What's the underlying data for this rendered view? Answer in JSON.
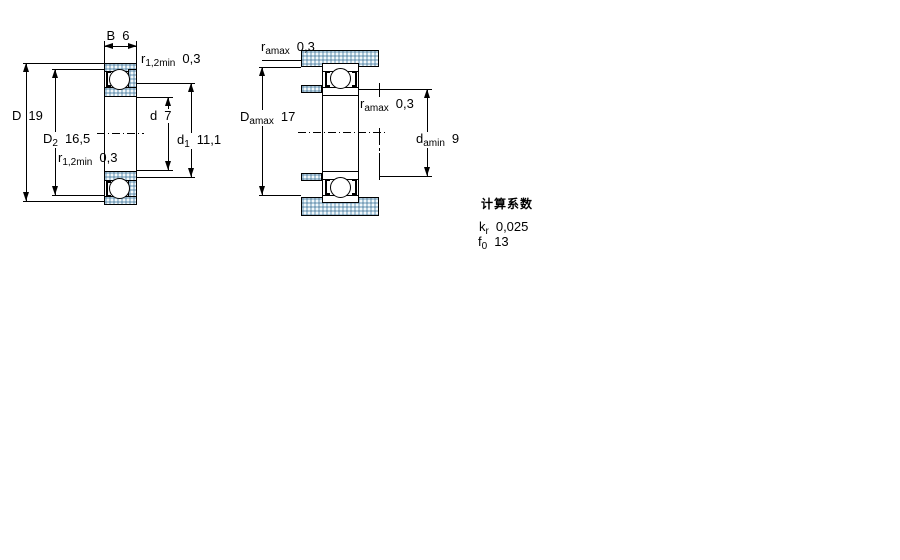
{
  "colors": {
    "background": "#ffffff",
    "line": "#000000",
    "hatch_fill": "#abc8da",
    "hatch_dot": "#7fa0b8"
  },
  "view1": {
    "name": "bearing cross-section, boundary dimensions",
    "dims": {
      "B": {
        "symbol": "B",
        "subscript": "",
        "value": "6"
      },
      "D": {
        "symbol": "D",
        "subscript": "",
        "value": "19"
      },
      "D2": {
        "symbol": "D",
        "subscript": "2",
        "value": "16,5"
      },
      "d": {
        "symbol": "d",
        "subscript": "",
        "value": "7"
      },
      "d1": {
        "symbol": "d",
        "subscript": "1",
        "value": "11,1"
      },
      "r_top": {
        "symbol": "r",
        "subscript": "1,2min",
        "value": "0,3"
      },
      "r_bot": {
        "symbol": "r",
        "subscript": "1,2min",
        "value": "0,3"
      }
    }
  },
  "view2": {
    "name": "bearing mounted, abutment and fillet dimensions",
    "dims": {
      "r_a_top": {
        "symbol": "r",
        "subscript": "amax",
        "value": "0,3"
      },
      "D_a": {
        "symbol": "D",
        "subscript": "amax",
        "value": "17"
      },
      "r_a_mid": {
        "symbol": "r",
        "subscript": "amax",
        "value": "0,3"
      },
      "d_a": {
        "symbol": "d",
        "subscript": "amin",
        "value": "9"
      }
    }
  },
  "calculation_factors": {
    "title": "计算系数",
    "rows": [
      {
        "symbol": "k",
        "subscript": "r",
        "value": "0,025"
      },
      {
        "symbol": "f",
        "subscript": "0",
        "value": "13"
      }
    ]
  }
}
